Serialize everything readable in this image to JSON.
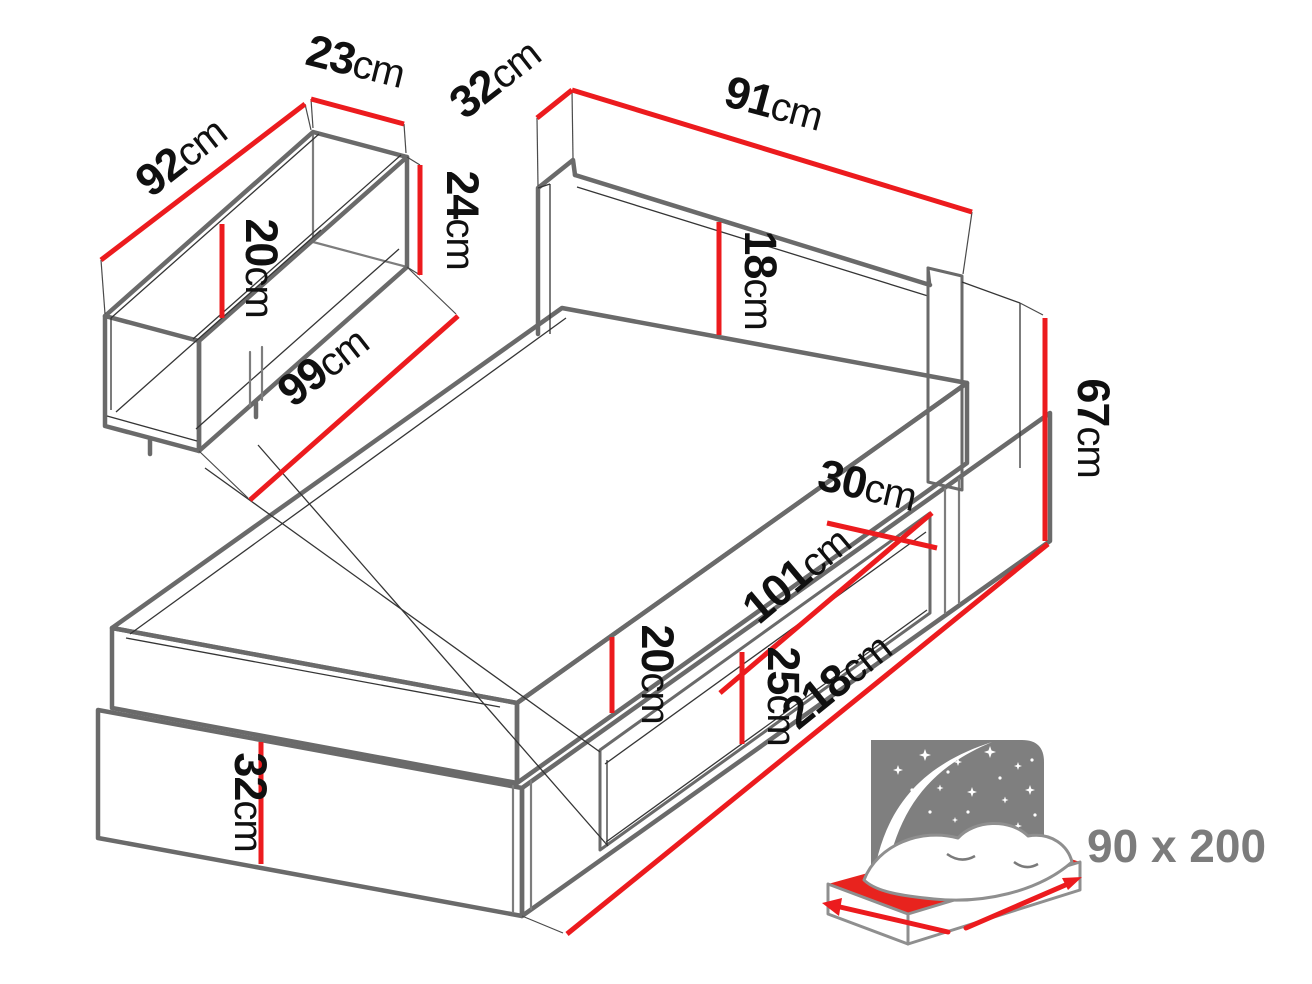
{
  "page": {
    "background": "#ffffff",
    "description": "Bed with storage drawer - dimension diagram"
  },
  "colors": {
    "outline_gray": "#6a6a6a",
    "dimension_red": "#ec1b1e",
    "label_black": "#101010",
    "icon_gray": "#7f7f7f",
    "icon_red": "#e8231e",
    "badge_gray": "#7c7c7c"
  },
  "dimensions": {
    "drawer_length": {
      "num": "92",
      "unit": "cm"
    },
    "drawer_top_width": {
      "num": "23",
      "unit": "cm"
    },
    "drawer_front_height": {
      "num": "24",
      "unit": "cm"
    },
    "drawer_inner_depth": {
      "num": "20",
      "unit": "cm"
    },
    "drawer_front_length": {
      "num": "99",
      "unit": "cm"
    },
    "headboard_top_depth": {
      "num": "32",
      "unit": "cm"
    },
    "headboard_width": {
      "num": "91",
      "unit": "cm"
    },
    "headboard_above_mattress": {
      "num": "18",
      "unit": "cm"
    },
    "headboard_side_height": {
      "num": "67",
      "unit": "cm"
    },
    "niche_depth": {
      "num": "30",
      "unit": "cm"
    },
    "niche_length": {
      "num": "101",
      "unit": "cm"
    },
    "niche_height": {
      "num": "25",
      "unit": "cm"
    },
    "mattress_height": {
      "num": "20",
      "unit": "cm"
    },
    "base_front_height": {
      "num": "32",
      "unit": "cm"
    },
    "bed_total_length": {
      "num": "218",
      "unit": "cm"
    }
  },
  "size_badge": {
    "label": "90 x 200"
  }
}
